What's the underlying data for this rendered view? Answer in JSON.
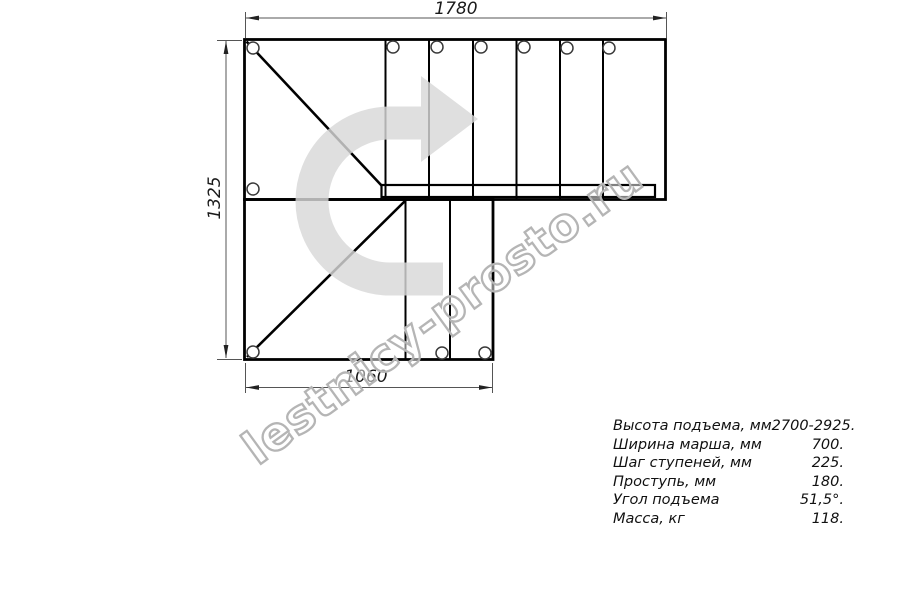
{
  "drawing": {
    "type": "staircase-top-view-blueprint",
    "dimensions": {
      "top": "1780",
      "left": "1325",
      "bottom": "1060"
    }
  },
  "specs": {
    "rows": [
      {
        "label": "Высота подъема, мм",
        "value": "2700-2925."
      },
      {
        "label": "Ширина марша, мм",
        "value": "700."
      },
      {
        "label": "Шаг ступеней, мм",
        "value": "225."
      },
      {
        "label": "Проступь, мм",
        "value": "180."
      },
      {
        "label": "Угол подъема",
        "value": "51,5°."
      },
      {
        "label": "Масса, кг",
        "value": "118."
      }
    ]
  },
  "watermark": {
    "text": "lestnicy-prosto.ru"
  },
  "icons": {
    "direction_arrow": "u-turn-right-arrow"
  },
  "colors": {
    "line": "#000000",
    "dimension_line": "#555555",
    "arrow_fill": "#d8d8d8",
    "watermark_stroke": "#b5b5b5"
  }
}
